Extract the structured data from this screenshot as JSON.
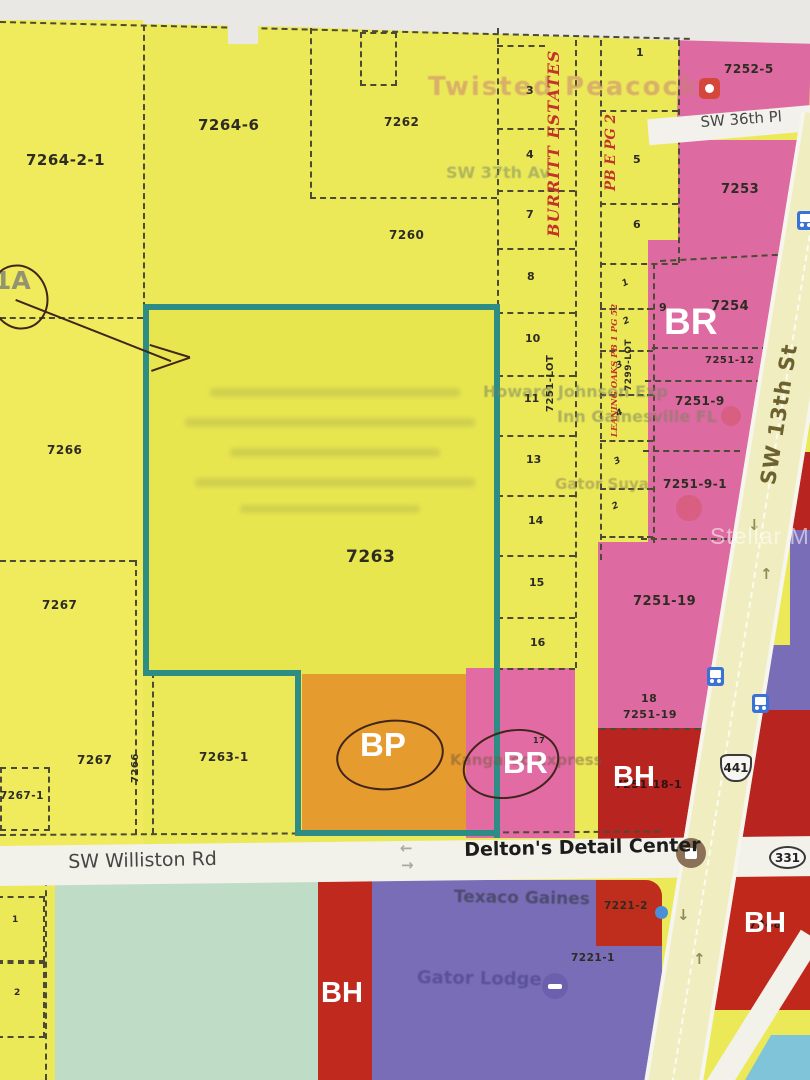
{
  "map": {
    "watermark": "Stellar MLS",
    "shields": {
      "us441": "441",
      "sr331": "331"
    },
    "colors": {
      "parcel_yellow": "#ece959",
      "zone_pink_br": "#dd6aa0",
      "zone_orange_bp": "#e69b2f",
      "zone_red_bh": "#b8241f",
      "zone_purple": "#7a6db7",
      "zone_mint": "#bfdcc6",
      "boundary_teal": "#2d8d84",
      "road_pale": "#f0eec0",
      "plat_red": "#c23329",
      "light_blue": "#7fc4d8"
    },
    "streets": [
      {
        "n": "street-sw-36th-pl",
        "t": "SW 36th Pl",
        "x": 700,
        "y": 115,
        "fs": 15,
        "rot": -4,
        "c": "street"
      },
      {
        "n": "street-sw-williston-rd",
        "t": "SW Williston Rd",
        "x": 68,
        "y": 853,
        "fs": 19,
        "rot": -1.2,
        "c": "street"
      },
      {
        "n": "street-deltons-detail-center",
        "t": "Delton's Detail Center",
        "x": 464,
        "y": 841,
        "fs": 19,
        "rot": -1.2,
        "c": "street dark"
      },
      {
        "n": "street-sw-13th-st",
        "t": "SW 13th St",
        "x": 758,
        "y": 483,
        "fs": 21,
        "rot": -81,
        "c": "street olive"
      }
    ],
    "zones": [
      {
        "n": "zone-label-br-main",
        "t": "BR",
        "x": 664,
        "y": 303,
        "fs": 37
      },
      {
        "n": "zone-label-bp",
        "t": "BP",
        "x": 360,
        "y": 728,
        "fs": 33
      },
      {
        "n": "zone-label-br-lot",
        "t": "BR",
        "x": 503,
        "y": 747,
        "fs": 31
      },
      {
        "n": "zone-label-bh-mid",
        "t": "BH",
        "x": 613,
        "y": 763,
        "fs": 29
      },
      {
        "n": "zone-label-bh-southwest",
        "t": "BH",
        "x": 321,
        "y": 979,
        "fs": 29
      },
      {
        "n": "zone-label-bh-southeast",
        "t": "BH",
        "x": 744,
        "y": 909,
        "fs": 29
      }
    ],
    "parcel_labels": [
      {
        "n": "parcel-7264-2-1",
        "t": "7264-2-1",
        "x": 26,
        "y": 153,
        "fs": 15
      },
      {
        "n": "parcel-7264-6",
        "t": "7264-6",
        "x": 198,
        "y": 118,
        "fs": 15
      },
      {
        "n": "parcel-7262",
        "t": "7262",
        "x": 384,
        "y": 116,
        "fs": 12
      },
      {
        "n": "parcel-7260",
        "t": "7260",
        "x": 389,
        "y": 229,
        "fs": 12
      },
      {
        "n": "parcel-7266",
        "t": "7266",
        "x": 47,
        "y": 444,
        "fs": 12
      },
      {
        "n": "parcel-7267-upper",
        "t": "7267",
        "x": 42,
        "y": 599,
        "fs": 12
      },
      {
        "n": "parcel-7267-lower",
        "t": "7267",
        "x": 77,
        "y": 754,
        "fs": 12
      },
      {
        "n": "parcel-7267-1",
        "t": "7267-1",
        "x": 0,
        "y": 791,
        "fs": 10.5
      },
      {
        "n": "parcel-7266-strip",
        "t": "7266",
        "x": 131,
        "y": 783,
        "fs": 10,
        "rot": -90
      },
      {
        "n": "parcel-7263",
        "t": "7263",
        "x": 346,
        "y": 549,
        "fs": 17
      },
      {
        "n": "parcel-7263-1",
        "t": "7263-1",
        "x": 199,
        "y": 751,
        "fs": 12
      },
      {
        "n": "parcel-7252-5",
        "t": "7252-5",
        "x": 724,
        "y": 63,
        "fs": 12
      },
      {
        "n": "parcel-7253",
        "t": "7253",
        "x": 721,
        "y": 183,
        "fs": 13
      },
      {
        "n": "parcel-7254",
        "t": "7254",
        "x": 711,
        "y": 300,
        "fs": 13
      },
      {
        "n": "parcel-7251-12",
        "t": "7251-12",
        "x": 705,
        "y": 356,
        "fs": 10
      },
      {
        "n": "parcel-7251-9",
        "t": "7251-9",
        "x": 675,
        "y": 395,
        "fs": 12
      },
      {
        "n": "parcel-7251-9-1",
        "t": "7251-9-1",
        "x": 663,
        "y": 478,
        "fs": 12
      },
      {
        "n": "parcel-7251-19",
        "t": "7251-19",
        "x": 633,
        "y": 595,
        "fs": 13
      },
      {
        "n": "parcel-lot-18",
        "t": "18",
        "x": 641,
        "y": 693,
        "fs": 11
      },
      {
        "n": "parcel-7251-19-lower",
        "t": "7251-19",
        "x": 623,
        "y": 709,
        "fs": 11
      },
      {
        "n": "parcel-7251-18-1",
        "t": "7251-18-1",
        "x": 615,
        "y": 779,
        "fs": 11,
        "col": "#2a1310"
      },
      {
        "n": "parcel-7221-2",
        "t": "7221-2",
        "x": 604,
        "y": 901,
        "fs": 10.5
      },
      {
        "n": "parcel-7221-1",
        "t": "7221-1",
        "x": 571,
        "y": 953,
        "fs": 10.5
      },
      {
        "n": "parcel-7248-obscured",
        "t": "7248",
        "x": 749,
        "y": 919,
        "fs": 11,
        "col": "#33120e"
      },
      {
        "n": "parcel-lot-9",
        "t": "9",
        "x": 659,
        "y": 302,
        "fs": 11
      },
      {
        "n": "parcel-lot-17",
        "t": "17",
        "x": 533,
        "y": 737,
        "fs": 8
      }
    ],
    "lot_numbers": [
      {
        "n": "lot-3",
        "t": "3",
        "x": 526,
        "y": 85,
        "fs": 11
      },
      {
        "n": "lot-4",
        "t": "4",
        "x": 526,
        "y": 149,
        "fs": 11
      },
      {
        "n": "lot-7",
        "t": "7",
        "x": 526,
        "y": 209,
        "fs": 11
      },
      {
        "n": "lot-8",
        "t": "8",
        "x": 527,
        "y": 271,
        "fs": 11
      },
      {
        "n": "lot-10",
        "t": "10",
        "x": 525,
        "y": 333,
        "fs": 11
      },
      {
        "n": "lot-11",
        "t": "11",
        "x": 524,
        "y": 393,
        "fs": 11
      },
      {
        "n": "lot-13",
        "t": "13",
        "x": 526,
        "y": 454,
        "fs": 11
      },
      {
        "n": "lot-14",
        "t": "14",
        "x": 528,
        "y": 515,
        "fs": 11
      },
      {
        "n": "lot-15",
        "t": "15",
        "x": 529,
        "y": 577,
        "fs": 11
      },
      {
        "n": "lot-16",
        "t": "16",
        "x": 530,
        "y": 637,
        "fs": 11
      },
      {
        "n": "lot-1-block2",
        "t": "1",
        "x": 636,
        "y": 47,
        "fs": 11
      },
      {
        "n": "lot-5-block2",
        "t": "5",
        "x": 633,
        "y": 154,
        "fs": 11
      },
      {
        "n": "lot-6-block2",
        "t": "6",
        "x": 633,
        "y": 219,
        "fs": 11
      },
      {
        "n": "lot-1-block3",
        "t": "1",
        "x": 621,
        "y": 281,
        "fs": 9,
        "rot": -25,
        "c": "lot lot2"
      },
      {
        "n": "lot-2-block3",
        "t": "2",
        "x": 622,
        "y": 319,
        "fs": 9,
        "rot": -25,
        "c": "lot lot2"
      },
      {
        "n": "lot-3-block3",
        "t": "3",
        "x": 615,
        "y": 363,
        "fs": 9,
        "rot": -25,
        "c": "lot lot2"
      },
      {
        "n": "lot-4-block3",
        "t": "4",
        "x": 615,
        "y": 411,
        "fs": 9,
        "rot": -25,
        "c": "lot lot2"
      },
      {
        "n": "lot-3b-block3",
        "t": "3",
        "x": 613,
        "y": 459,
        "fs": 9,
        "rot": -25,
        "c": "lot lot2"
      },
      {
        "n": "lot-2b-block3",
        "t": "2",
        "x": 611,
        "y": 504,
        "fs": 9,
        "rot": -25,
        "c": "lot lot2"
      },
      {
        "n": "lot-1-south",
        "t": "1",
        "x": 12,
        "y": 916,
        "fs": 9
      },
      {
        "n": "lot-2-south",
        "t": "2",
        "x": 14,
        "y": 989,
        "fs": 9
      }
    ],
    "plat_texts": [
      {
        "n": "plat-burritt-estates",
        "t": "BURRITT  ESTATES",
        "x": 546,
        "y": 237,
        "fs": 16,
        "rot": -90,
        "c": "plat",
        "ls": 1
      },
      {
        "n": "plat-pb-e-pg-2",
        "t": "PB  E  PG 2",
        "x": 605,
        "y": 191,
        "fs": 13.5,
        "rot": -90,
        "c": "plat"
      },
      {
        "n": "plat-leaning-oaks",
        "t": "LEANING OAKS PB 1 PG 52",
        "x": 611,
        "y": 437,
        "fs": 8.5,
        "rot": -90,
        "c": "plat"
      },
      {
        "n": "plat-7251-lot",
        "t": "7251-LOT",
        "x": 546,
        "y": 412,
        "fs": 10,
        "rot": -90,
        "c": "platk"
      },
      {
        "n": "plat-7299-lot",
        "t": "7299-LOT",
        "x": 625,
        "y": 391,
        "fs": 9,
        "rot": -90,
        "c": "platk"
      }
    ],
    "ghost_labels": [
      {
        "n": "ghost-twisted-peacock",
        "t": "Twisted Peacock",
        "x": 428,
        "y": 74,
        "fs": 26,
        "col": "rgba(200,130,115,0.55)",
        "ls": 2
      },
      {
        "n": "ghost-sw-37th-av",
        "t": "SW 37th Av",
        "x": 446,
        "y": 165,
        "fs": 16,
        "col": "rgba(125,138,95,0.55)"
      },
      {
        "n": "ghost-howard-johnson",
        "t": "Howard Johnson Exp",
        "x": 483,
        "y": 384,
        "fs": 16,
        "col": "rgba(120,132,92,0.55)"
      },
      {
        "n": "ghost-inn-gainesville",
        "t": "Inn Gainesville FL",
        "x": 557,
        "y": 409,
        "fs": 16,
        "col": "rgba(120,132,92,0.55)"
      },
      {
        "n": "ghost-gator-suya",
        "t": "Gator Suya",
        "x": 555,
        "y": 477,
        "fs": 15,
        "col": "rgba(135,122,82,0.5)"
      },
      {
        "n": "ghost-kangaroo-express",
        "t": "Kangaroo Express",
        "x": 450,
        "y": 753,
        "fs": 15,
        "col": "rgba(115,88,58,0.5)"
      },
      {
        "n": "ghost-texaco-gaines",
        "t": "Texaco Gaines",
        "x": 454,
        "y": 889,
        "fs": 17,
        "rot": 1,
        "col": "rgba(55,60,80,0.7)"
      },
      {
        "n": "ghost-gator-lodge",
        "t": "Gator Lodge",
        "x": 417,
        "y": 969,
        "fs": 18,
        "rot": 1,
        "col": "rgba(85,75,152,0.85)"
      }
    ],
    "road_arrows": [
      {
        "n": "lane-arrow-down-1",
        "t": "↓",
        "x": 748,
        "y": 518,
        "fs": 15
      },
      {
        "n": "lane-arrow-up-1",
        "t": "↑",
        "x": 760,
        "y": 567,
        "fs": 15
      },
      {
        "n": "lane-arrow-down-2",
        "t": "↓",
        "x": 677,
        "y": 908,
        "fs": 15
      },
      {
        "n": "lane-arrow-up-2",
        "t": "↑",
        "x": 693,
        "y": 952,
        "fs": 15
      }
    ],
    "gray_arrows": [
      {
        "n": "williston-arrow-left",
        "t": "←",
        "x": 400,
        "y": 841,
        "fs": 15
      },
      {
        "n": "williston-arrow-right",
        "t": "→",
        "x": 401,
        "y": 858,
        "fs": 15
      }
    ],
    "annotation": {
      "circled_letter": "1A"
    }
  }
}
